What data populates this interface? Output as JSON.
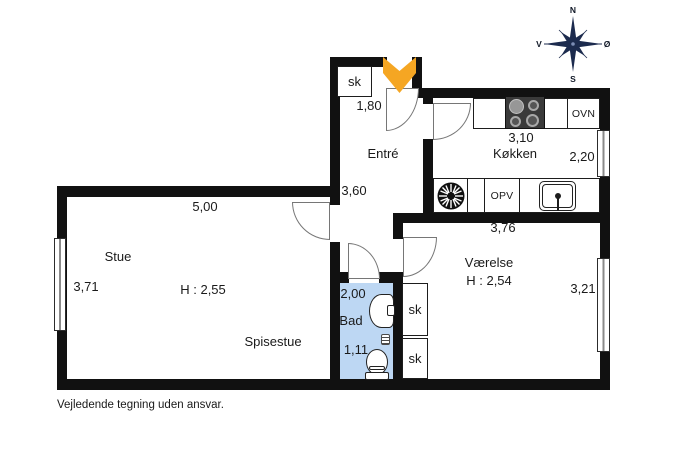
{
  "disclaimer": "Vejledende tegning uden ansvar.",
  "compass": {
    "n": "N",
    "s": "S",
    "v": "V",
    "o": "Ø"
  },
  "labels": {
    "stue": "Stue",
    "spisestue": "Spisestue",
    "entre": "Entré",
    "kokken": "Køkken",
    "vaerelse": "Værelse",
    "bad": "Bad",
    "sk_entre": "sk",
    "sk_hall_top": "sk",
    "sk_hall_bottom": "sk",
    "ovn": "OVN",
    "opv": "OPV",
    "h_stue": "H : 2,55",
    "h_vaerelse": "H : 2,54"
  },
  "dimensions": {
    "stue_width": "5,00",
    "stue_depth": "3,71",
    "entre_width": "1,80",
    "entre_depth": "3,60",
    "kokken_width": "3,10",
    "kokken_depth": "2,20",
    "vaerelse_width": "3,76",
    "vaerelse_depth": "3,21",
    "bad_width": "2,00",
    "bad_depth": "1,11"
  },
  "colors": {
    "wall": "#111111",
    "bath_floor": "#bdd7f3",
    "arrow": "#f5a623",
    "compass": "#1c2b4e",
    "door": "#767676"
  }
}
